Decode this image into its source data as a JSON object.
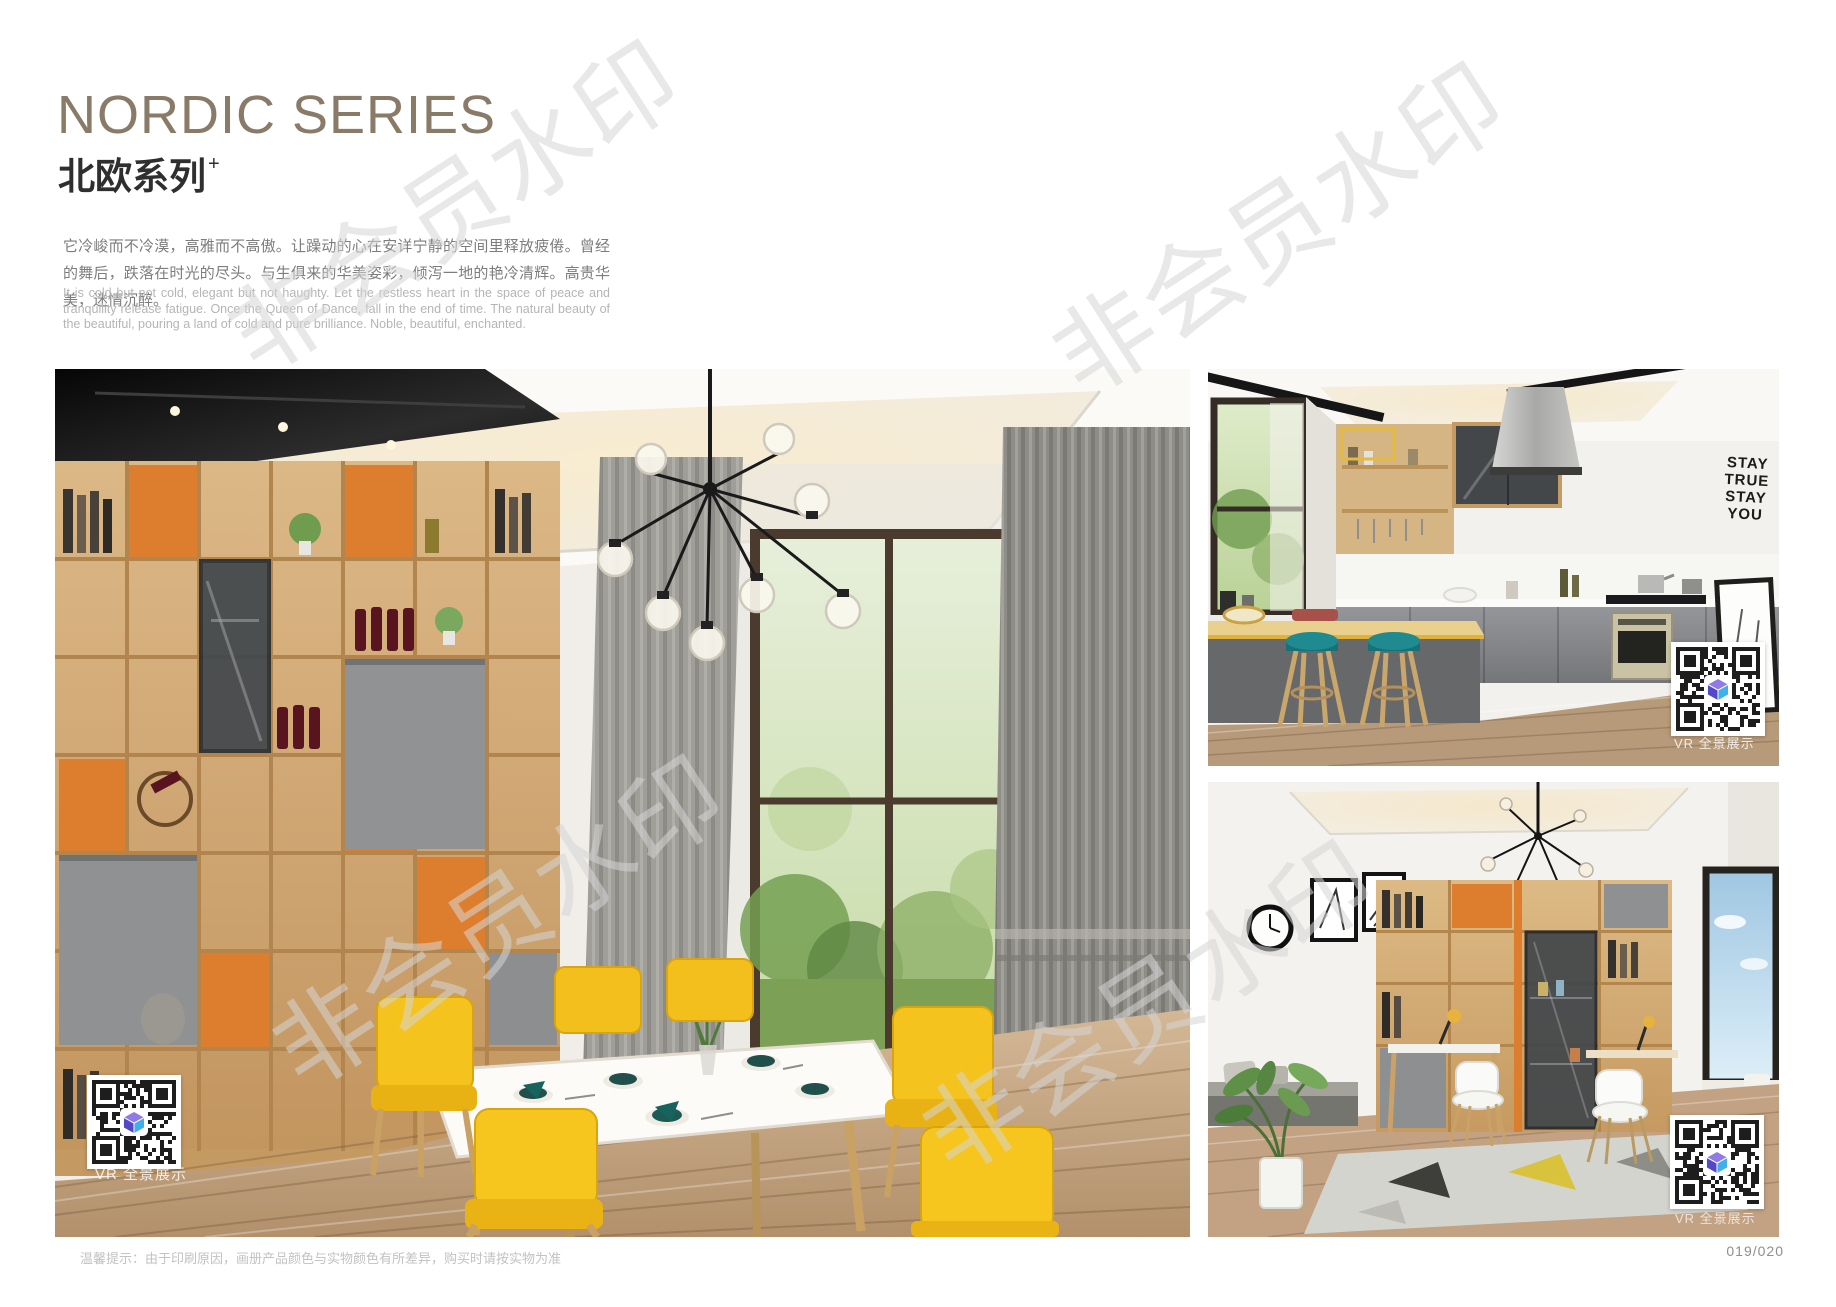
{
  "header": {
    "title_en": "NORDIC SERIES",
    "title_cn": "北欧系列",
    "title_sup": "+",
    "desc_cn": "它冷峻而不冷漠，高雅而不高傲。让躁动的心在安详宁静的空间里释放疲倦。曾经的舞后，跌落在时光的尽头。与生俱来的华美姿彩，倾泻一地的艳冷清辉。高贵华美，迷情沉醉。",
    "desc_en": "It is cold but not cold, elegant but not haughty. Let the restless heart in the space of peace and tranquility release fatigue. Once the Queen of Dance, fall in the end of time. The natural beauty of the beautiful, pouring a land of cold and pure brilliance. Noble, beautiful, enchanted."
  },
  "photos": {
    "dining": {
      "vr_label": "VR 全景展示"
    },
    "kitchen": {
      "vr_label": "VR 全景展示",
      "wall_words": [
        "STAY",
        "TRUE",
        "STAY",
        "YOU"
      ]
    },
    "study": {
      "vr_label": "VR 全景展示"
    }
  },
  "page": {
    "watermark": "非会员水印",
    "footer_note": "温馨提示：由于印刷原因，画册产品颜色与实物颜色有所差异，购买时请按实物为准",
    "number": "019/020"
  },
  "colors": {
    "title_taupe": "#8a7b69",
    "accent_orange": "#dd7e2e",
    "chair_yellow": "#f4c31d",
    "stool_teal": "#1f8a8f",
    "qr_module": "#1d1d1d"
  }
}
